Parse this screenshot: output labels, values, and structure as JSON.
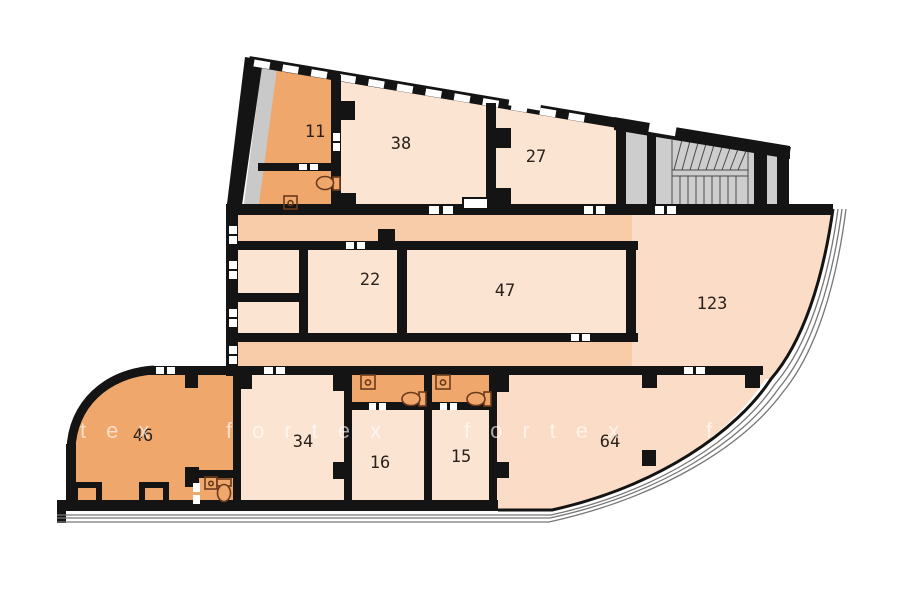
{
  "plan": {
    "kind": "architectural floor plan",
    "rooms": [
      {
        "id": "room-11",
        "label": "11"
      },
      {
        "id": "room-38",
        "label": "38"
      },
      {
        "id": "room-27",
        "label": "27"
      },
      {
        "id": "room-22",
        "label": "22"
      },
      {
        "id": "room-47",
        "label": "47"
      },
      {
        "id": "room-123",
        "label": "123"
      },
      {
        "id": "room-46",
        "label": "46"
      },
      {
        "id": "room-34",
        "label": "34"
      },
      {
        "id": "room-16",
        "label": "16"
      },
      {
        "id": "room-15",
        "label": "15"
      },
      {
        "id": "room-64",
        "label": "64"
      }
    ]
  },
  "watermark": {
    "word": "fortex",
    "tiles": [
      {
        "text": "tex"
      },
      {
        "text": "fortex"
      },
      {
        "text": "fortex"
      },
      {
        "text": "f"
      }
    ]
  },
  "colors": {
    "room_light": "#fce4d3",
    "corridor": "#f8cba9",
    "room_orange": "#f0a76c",
    "hall_pale": "#fbdcc6",
    "stair_gray": "#cdcdcd",
    "wall": "#141414",
    "fixture_outline": "#6b3a1c",
    "facade_line": "#777777",
    "watermark_text": "rgba(255,255,255,0.62)"
  }
}
